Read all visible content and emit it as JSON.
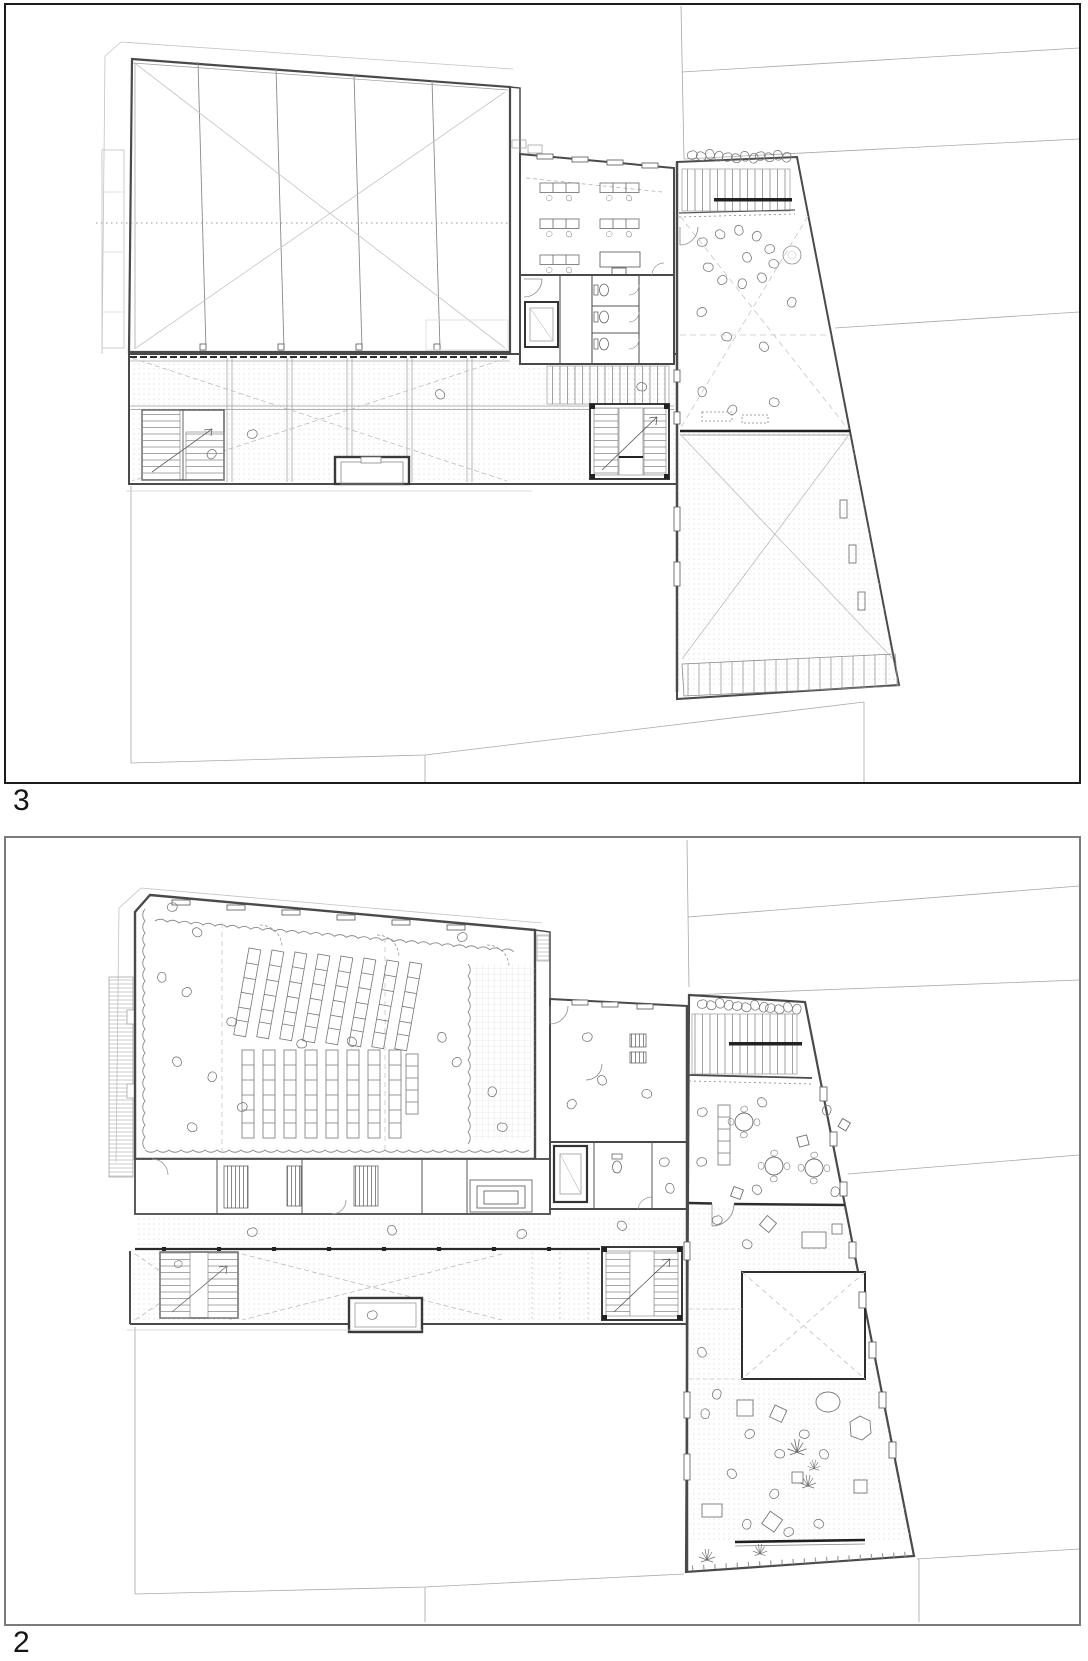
{
  "sheet": {
    "background": "#ffffff",
    "drawing_type": "architectural floor plans",
    "colors": {
      "paper": "#ffffff",
      "panel_border_upper": "#1c1c1c",
      "panel_border_lower": "#7b7b7b",
      "wall_ink": "#4a4a4a",
      "heavy_ink": "#1f1f1f",
      "light_line": "#9a9a9a",
      "hatch_dot": "#c4c4c4"
    }
  },
  "panels": [
    {
      "label": "3",
      "name": "floor-plan-level-3"
    },
    {
      "label": "2",
      "name": "floor-plan-level-2"
    }
  ]
}
